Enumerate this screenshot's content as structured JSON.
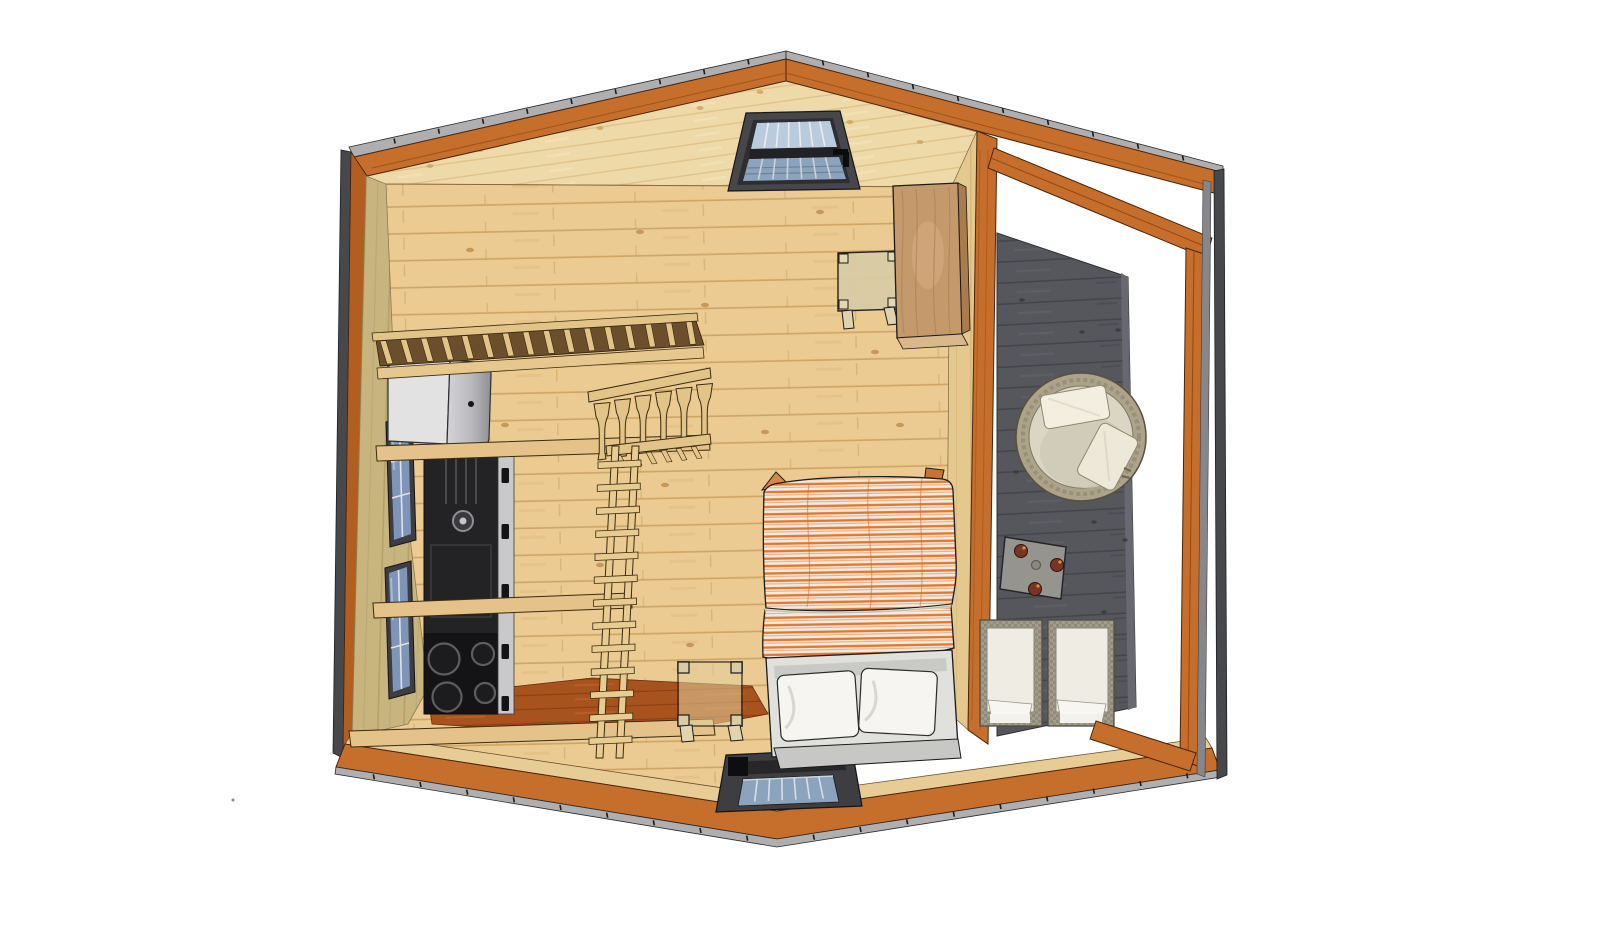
{
  "scene": {
    "title": "Tiny cabin - top-down 3D cutaway floor plan render",
    "view": "overhead cutaway, sketchup-style",
    "background": "#ffffff"
  },
  "colors": {
    "fascia_orange": "#C66E2B",
    "fascia_orange_dark": "#B35E21",
    "fascia_edge_line": "#4A240A",
    "roof_edge_gray": "#AFAFB2",
    "side_edge_dark": "#47484C",
    "side_edge_light": "#87878B",
    "gable_pine": "#EED9A8",
    "floor_pine": "#EBCB92",
    "plank_line": "#C9A05F",
    "left_wall_khaki": "#C8B47E",
    "right_wall_pine": "#E4C88E",
    "kitchen_terracotta": "#A8521E",
    "counter_pine": "#E4C289",
    "loft_slat_pine": "#E3C488",
    "ladder_pine": "#E8CB90",
    "deck_gray": "#56575D",
    "deck_plank_line": "#45464A",
    "appliance_black": "#232326",
    "fridge_gray": "#E2E2E2",
    "duvet_white": "#F0EADF",
    "duvet_stripe_orange": "#E1762E",
    "bench_white": "#E0E0DD",
    "pillow_white": "#F6F5F1",
    "hot_tub_ring": "#ADA38B",
    "hot_tub_bowl": "#DBD6C4",
    "wicker": "#A29C8B",
    "chair_cushion": "#EFEDE3",
    "table_gray": "#96948E",
    "knob_red": "#7A3426",
    "window_frame": "#3E3E42",
    "window_glass": "#8CA3BE",
    "window_glass_light": "#B9CBDD"
  },
  "counts": {
    "loft_slats": 16,
    "ladder_rungs": 13,
    "railing_balusters": 6,
    "stove_burners": 4,
    "deck_chairs": 2,
    "hot_tub_pillows": 2,
    "bench_pillows": 2,
    "skylight_windows": 2,
    "left_wall_windows": 2
  },
  "objects": {
    "gable_skylight": {
      "label": "Gable skylight window"
    },
    "front_skylight": {
      "label": "Front wall window"
    },
    "loft": {
      "label": "Sleeping loft slatted edge"
    },
    "ladder": {
      "label": "Loft ladder"
    },
    "railing": {
      "label": "Loft railing with turned balusters"
    },
    "fridge": {
      "label": "Refrigerator"
    },
    "range": {
      "label": "Kitchen range with 4-burner cooktop"
    },
    "counters": {
      "label": "Kitchen counters"
    },
    "bed": {
      "label": "Double bed with orange striped duvet"
    },
    "bench": {
      "label": "Headboard bench with two pillows"
    },
    "side_table": {
      "label": "Bedside table"
    },
    "desk": {
      "label": "Small desk"
    },
    "cabinet": {
      "label": "Wardrobe cabinet"
    },
    "hot_tub": {
      "label": "Round hot tub with towels"
    },
    "deck_table": {
      "label": "Deck side table with burner knobs"
    },
    "deck_chairs": {
      "label": "Two wicker deck loungers"
    },
    "deck": {
      "label": "Dark stained side deck"
    }
  }
}
